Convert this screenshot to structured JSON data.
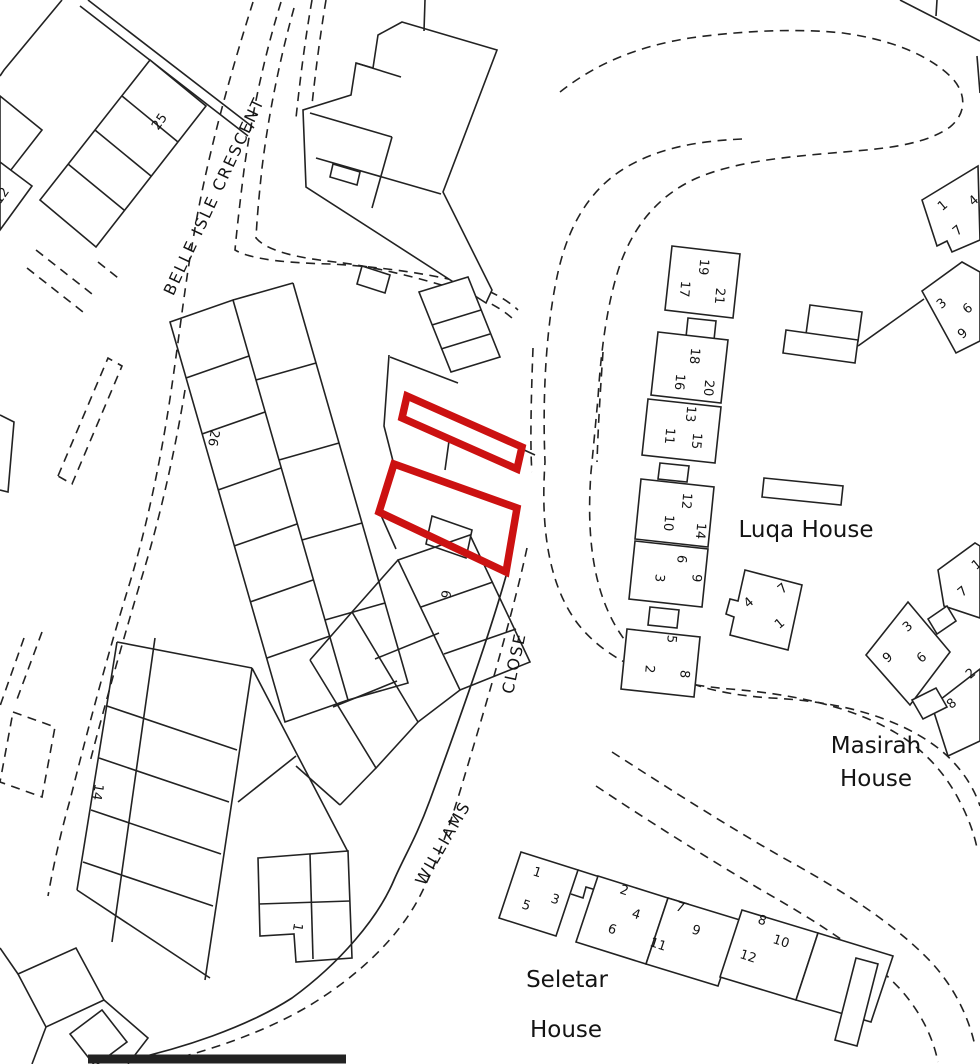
{
  "colors": {
    "background": "#ffffff",
    "map_line": "#222222",
    "plot_highlight_red": "#cc1111",
    "label_text": "#141414"
  },
  "streets": [
    {
      "name": "BELLE ISLE CRESCENT"
    },
    {
      "name": "WILLIAMS CLOSE"
    }
  ],
  "houses": [
    {
      "name": "Luqa House"
    },
    {
      "name": "Masirah House"
    },
    {
      "name": "Seletar House"
    }
  ],
  "highlighted_plots": {
    "count": 2,
    "style": "red-outline"
  },
  "labels": [
    {
      "text": "25",
      "x": 160,
      "y": 122,
      "rot": -55,
      "kind": "number"
    },
    {
      "text": "12",
      "x": 2,
      "y": 196,
      "rot": -55,
      "kind": "number"
    },
    {
      "text": "26",
      "x": 213,
      "y": 438,
      "rot": 100,
      "kind": "number"
    },
    {
      "text": "14",
      "x": 97,
      "y": 792,
      "rot": 100,
      "kind": "number"
    },
    {
      "text": "1",
      "x": 297,
      "y": 927,
      "rot": 100,
      "kind": "number"
    },
    {
      "text": "6",
      "x": 445,
      "y": 594,
      "rot": 100,
      "kind": "number"
    },
    {
      "text": "17",
      "x": 684,
      "y": 289,
      "rot": 95,
      "kind": "number"
    },
    {
      "text": "19",
      "x": 703,
      "y": 267,
      "rot": 95,
      "kind": "number"
    },
    {
      "text": "21",
      "x": 719,
      "y": 296,
      "rot": 95,
      "kind": "number"
    },
    {
      "text": "18",
      "x": 694,
      "y": 356,
      "rot": 95,
      "kind": "number"
    },
    {
      "text": "16",
      "x": 679,
      "y": 382,
      "rot": 95,
      "kind": "number"
    },
    {
      "text": "20",
      "x": 708,
      "y": 388,
      "rot": 95,
      "kind": "number"
    },
    {
      "text": "13",
      "x": 690,
      "y": 414,
      "rot": 95,
      "kind": "number"
    },
    {
      "text": "11",
      "x": 669,
      "y": 436,
      "rot": 95,
      "kind": "number"
    },
    {
      "text": "15",
      "x": 696,
      "y": 441,
      "rot": 95,
      "kind": "number"
    },
    {
      "text": "12",
      "x": 686,
      "y": 501,
      "rot": 95,
      "kind": "number"
    },
    {
      "text": "10",
      "x": 668,
      "y": 523,
      "rot": 95,
      "kind": "number"
    },
    {
      "text": "14",
      "x": 700,
      "y": 531,
      "rot": 95,
      "kind": "number"
    },
    {
      "text": "6",
      "x": 681,
      "y": 559,
      "rot": 95,
      "kind": "number"
    },
    {
      "text": "3",
      "x": 659,
      "y": 578,
      "rot": 95,
      "kind": "number"
    },
    {
      "text": "9",
      "x": 696,
      "y": 578,
      "rot": 95,
      "kind": "number"
    },
    {
      "text": "5",
      "x": 671,
      "y": 639,
      "rot": 95,
      "kind": "number"
    },
    {
      "text": "2",
      "x": 649,
      "y": 669,
      "rot": 95,
      "kind": "number"
    },
    {
      "text": "8",
      "x": 684,
      "y": 674,
      "rot": 95,
      "kind": "number"
    },
    {
      "text": "7",
      "x": 783,
      "y": 589,
      "rot": -40,
      "kind": "number"
    },
    {
      "text": "4",
      "x": 749,
      "y": 603,
      "rot": -40,
      "kind": "number"
    },
    {
      "text": "1",
      "x": 780,
      "y": 624,
      "rot": -40,
      "kind": "number"
    },
    {
      "text": "1",
      "x": 943,
      "y": 206,
      "rot": -40,
      "kind": "number"
    },
    {
      "text": "4",
      "x": 974,
      "y": 201,
      "rot": -40,
      "kind": "number"
    },
    {
      "text": "7",
      "x": 958,
      "y": 231,
      "rot": -40,
      "kind": "number"
    },
    {
      "text": "3",
      "x": 942,
      "y": 304,
      "rot": -40,
      "kind": "number"
    },
    {
      "text": "6",
      "x": 968,
      "y": 309,
      "rot": -40,
      "kind": "number"
    },
    {
      "text": "9",
      "x": 963,
      "y": 334,
      "rot": -40,
      "kind": "number"
    },
    {
      "text": "3",
      "x": 908,
      "y": 627,
      "rot": -40,
      "kind": "number"
    },
    {
      "text": "9",
      "x": 888,
      "y": 658,
      "rot": -40,
      "kind": "number"
    },
    {
      "text": "6",
      "x": 922,
      "y": 658,
      "rot": -40,
      "kind": "number"
    },
    {
      "text": "1",
      "x": 977,
      "y": 565,
      "rot": -40,
      "kind": "number"
    },
    {
      "text": "7",
      "x": 963,
      "y": 592,
      "rot": -40,
      "kind": "number"
    },
    {
      "text": "2",
      "x": 971,
      "y": 674,
      "rot": -40,
      "kind": "number"
    },
    {
      "text": "8",
      "x": 952,
      "y": 704,
      "rot": -40,
      "kind": "number"
    },
    {
      "text": "1",
      "x": 537,
      "y": 873,
      "rot": 18,
      "kind": "number"
    },
    {
      "text": "3",
      "x": 555,
      "y": 900,
      "rot": 18,
      "kind": "number"
    },
    {
      "text": "5",
      "x": 526,
      "y": 906,
      "rot": 18,
      "kind": "number"
    },
    {
      "text": "2",
      "x": 624,
      "y": 891,
      "rot": 18,
      "kind": "number"
    },
    {
      "text": "4",
      "x": 636,
      "y": 915,
      "rot": 18,
      "kind": "number"
    },
    {
      "text": "6",
      "x": 612,
      "y": 930,
      "rot": 18,
      "kind": "number"
    },
    {
      "text": "11",
      "x": 658,
      "y": 945,
      "rot": 18,
      "kind": "number"
    },
    {
      "text": "7",
      "x": 680,
      "y": 908,
      "rot": 18,
      "kind": "number"
    },
    {
      "text": "9",
      "x": 696,
      "y": 931,
      "rot": 18,
      "kind": "number"
    },
    {
      "text": "8",
      "x": 762,
      "y": 921,
      "rot": 18,
      "kind": "number"
    },
    {
      "text": "12",
      "x": 748,
      "y": 957,
      "rot": 18,
      "kind": "number"
    },
    {
      "text": "10",
      "x": 781,
      "y": 942,
      "rot": 18,
      "kind": "number"
    },
    {
      "text": "BELLE ISLE CRESCENT",
      "x": 214,
      "y": 196,
      "rot": -65,
      "kind": "street"
    },
    {
      "text": "WILLIAMS",
      "x": 443,
      "y": 843,
      "rot": -60,
      "kind": "street"
    },
    {
      "text": "CLOSE",
      "x": 514,
      "y": 663,
      "rot": -78,
      "kind": "street"
    },
    {
      "text": "Luqa House",
      "x": 806,
      "y": 530,
      "rot": 0,
      "kind": "house"
    },
    {
      "text": "Masirah",
      "x": 876,
      "y": 746,
      "rot": 0,
      "kind": "house"
    },
    {
      "text": "House",
      "x": 876,
      "y": 779,
      "rot": 0,
      "kind": "house"
    },
    {
      "text": "Seletar",
      "x": 567,
      "y": 980,
      "rot": 0,
      "kind": "house"
    },
    {
      "text": "House",
      "x": 566,
      "y": 1030,
      "rot": 0,
      "kind": "house"
    }
  ]
}
